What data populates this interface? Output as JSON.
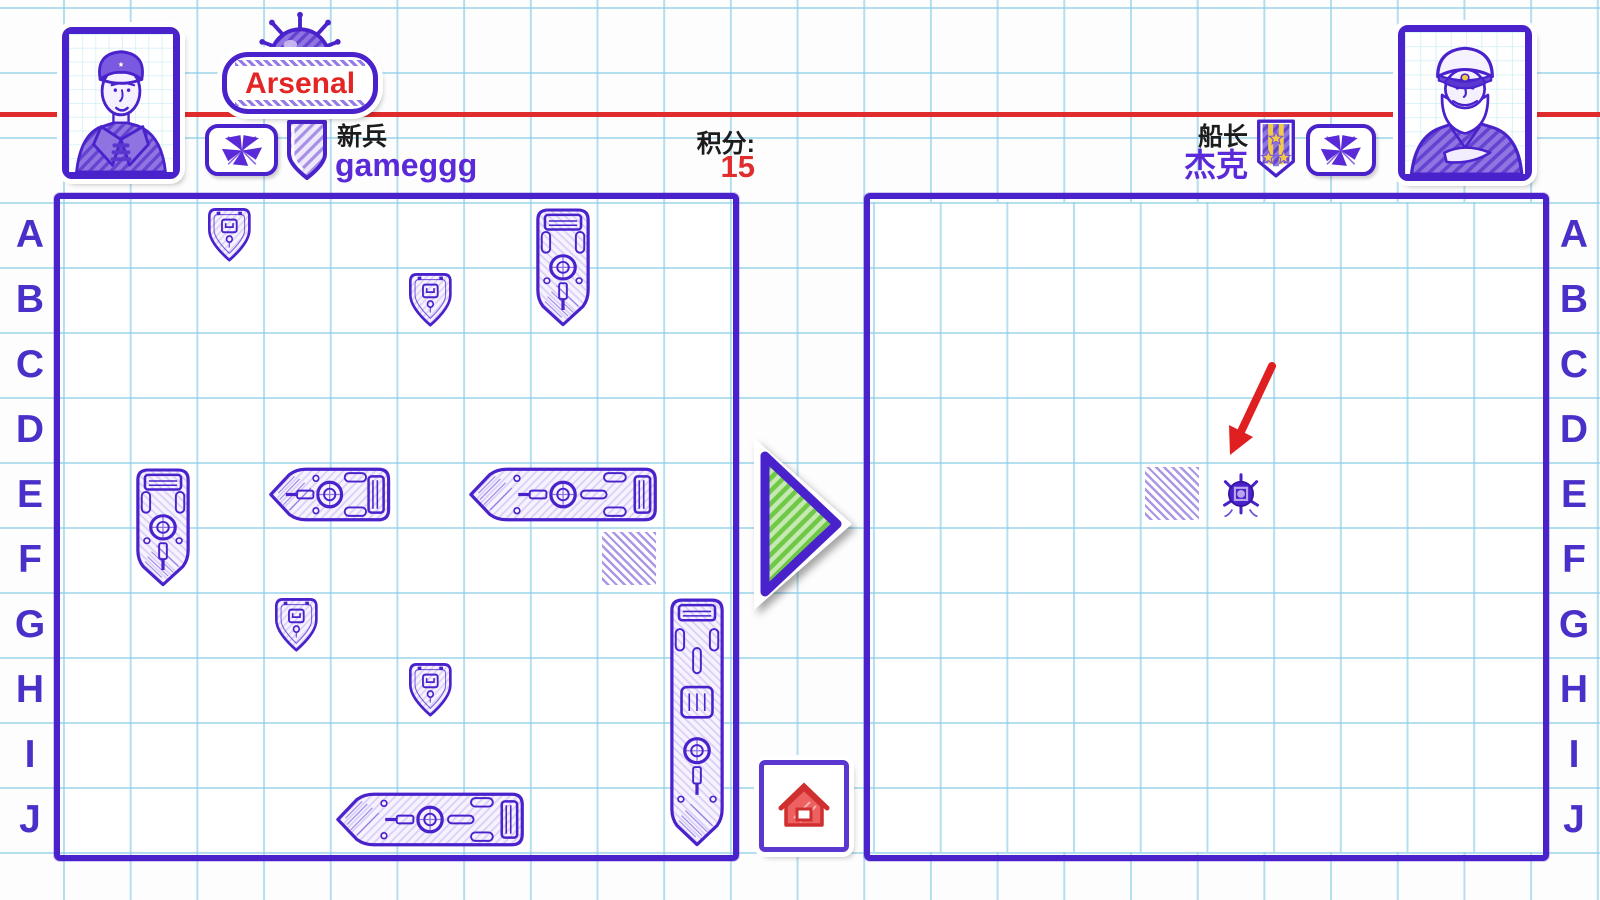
{
  "colors": {
    "ink": "#4a22cc",
    "bright_ink": "#5a2ad8",
    "red": "#e02c2c",
    "green": "#6fc846",
    "grid_line": "#8cceE6",
    "miss_hatch": "#ab97e6",
    "gold": "#f2ca43",
    "black_text": "#1c1c1c"
  },
  "header": {
    "arsenal": {
      "label": "Arsenal",
      "icon": "sea-mine-icon"
    },
    "left_player": {
      "avatar": "sailor-portrait",
      "flag_icon": "signal-flags-icon",
      "badge_icon": "shield-badge-icon",
      "rank": "新兵",
      "name": "gameggg"
    },
    "score": {
      "label": "积分:",
      "value": "15"
    },
    "right_player": {
      "avatar": "captain-portrait",
      "flag_icon": "signal-flags-icon",
      "medal_icon": "medal-ribbon-icon",
      "rank": "船长",
      "name": "杰克"
    }
  },
  "boards": {
    "row_labels": [
      "A",
      "B",
      "C",
      "D",
      "E",
      "F",
      "G",
      "H",
      "I",
      "J"
    ],
    "player": {
      "ships": [
        {
          "cell": "A3",
          "size": 1,
          "orient": "v"
        },
        {
          "cell": "B6",
          "size": 1,
          "orient": "v"
        },
        {
          "cell": "A8",
          "size": 2,
          "orient": "v"
        },
        {
          "cell": "E2",
          "size": 2,
          "orient": "v"
        },
        {
          "cell": "E4",
          "size": 2,
          "orient": "h"
        },
        {
          "cell": "E7",
          "size": 3,
          "orient": "h"
        },
        {
          "cell": "G4",
          "size": 1,
          "orient": "v"
        },
        {
          "cell": "H6",
          "size": 1,
          "orient": "v"
        },
        {
          "cell": "J5",
          "size": 3,
          "orient": "h"
        },
        {
          "cell": "G10",
          "size": 4,
          "orient": "v"
        }
      ],
      "misses": [
        "F9"
      ]
    },
    "enemy": {
      "misses": [
        "E5"
      ],
      "destroyed": [
        "E6"
      ],
      "arrow_target": "E6"
    }
  },
  "middle": {
    "turn_arrow_icon": "green-right-arrow-icon",
    "home_icon": "home-icon"
  }
}
